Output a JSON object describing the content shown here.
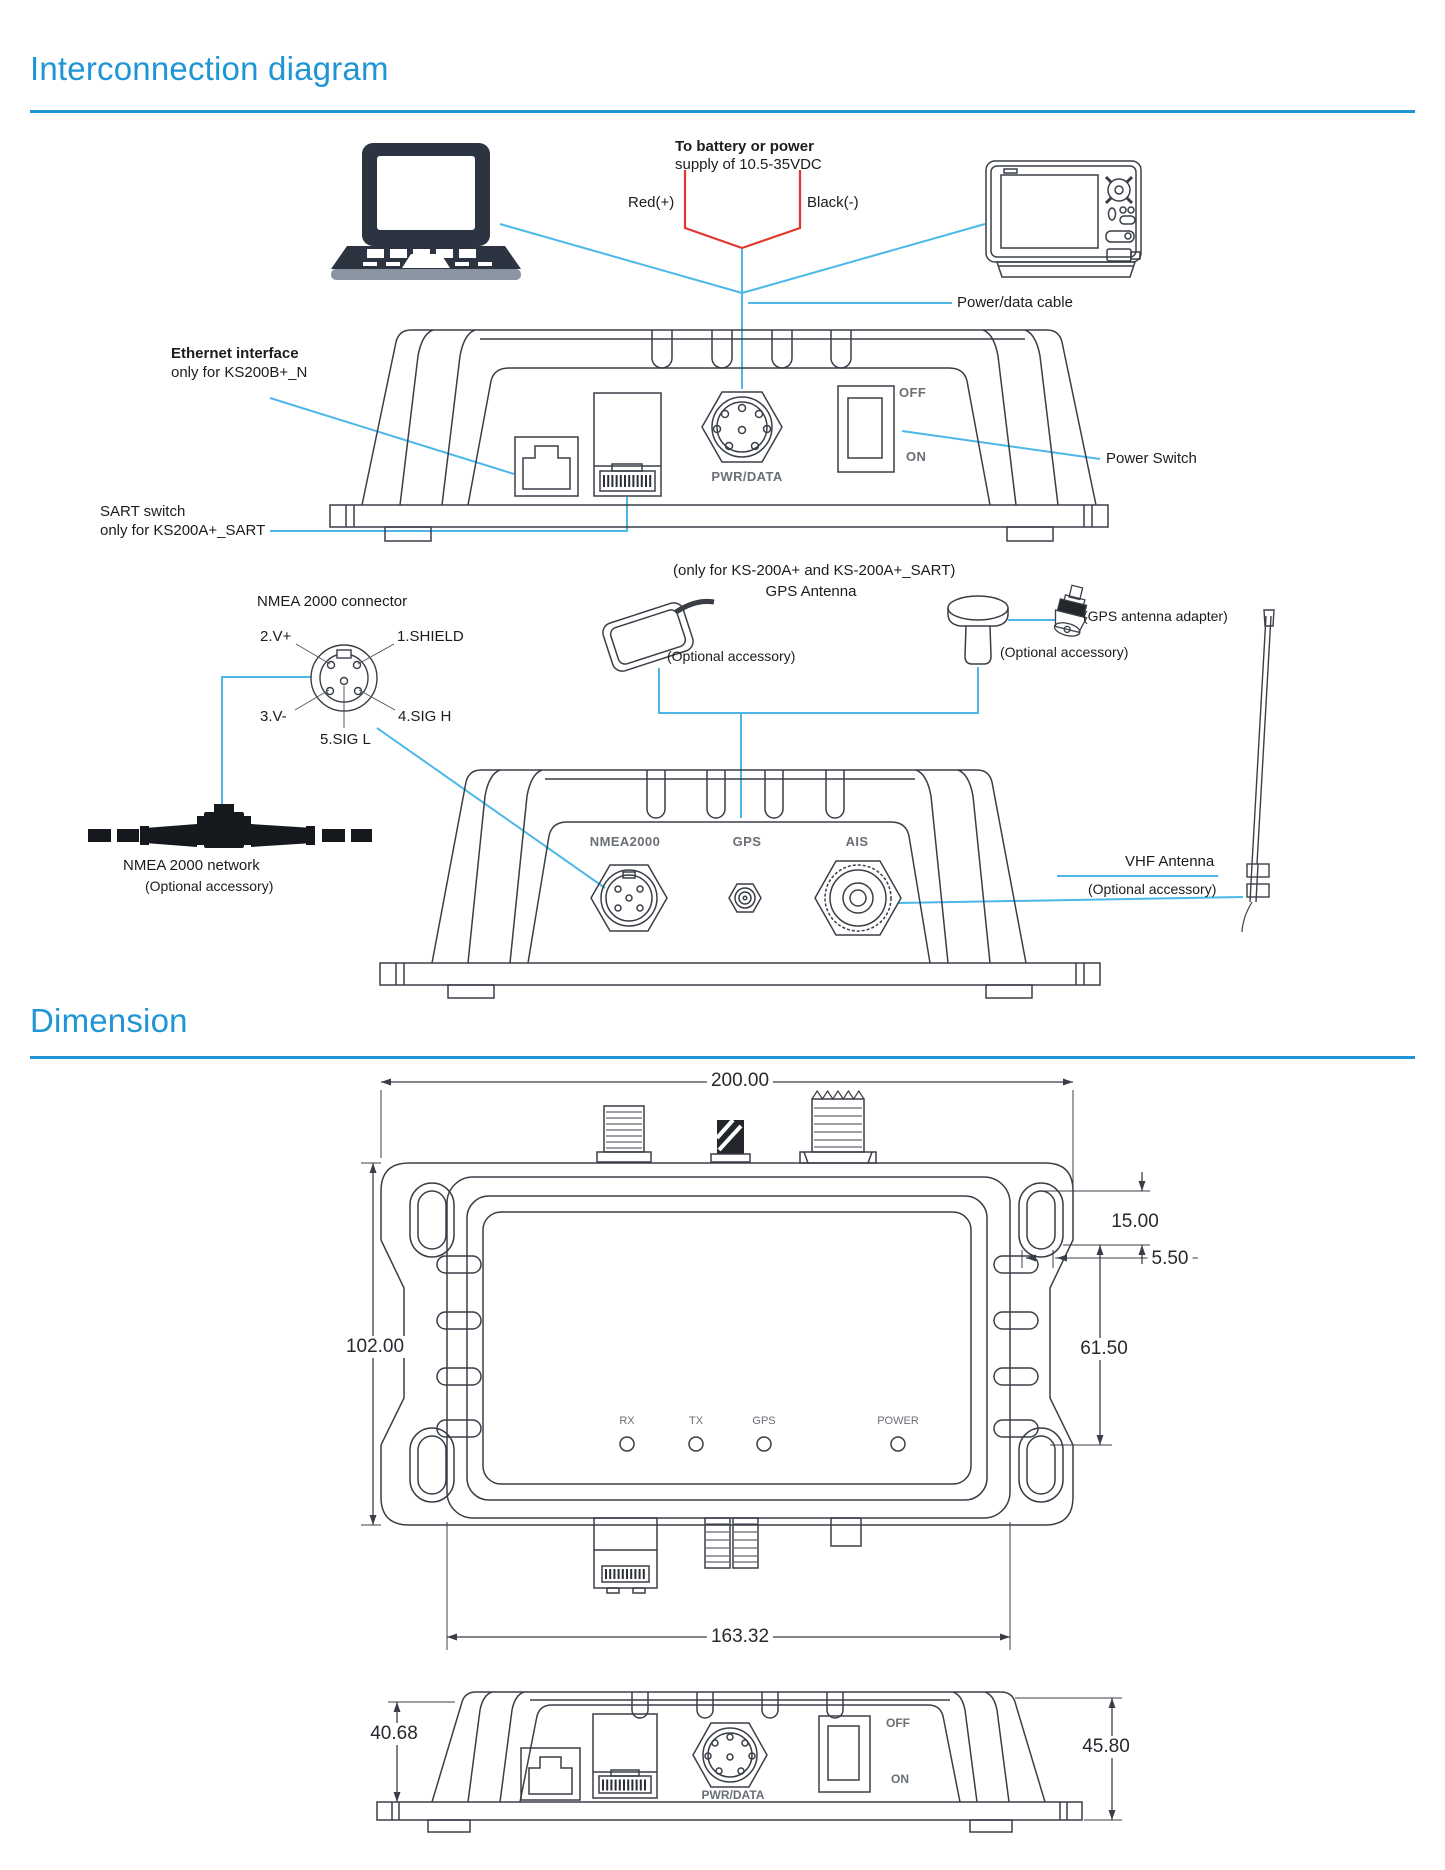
{
  "page": {
    "title1": "Interconnection diagram",
    "title2": "Dimension"
  },
  "colors": {
    "heading_blue": "#2095d5",
    "wire_blue": "#4cb8e8",
    "wire_red": "#e2382c",
    "ink": "#3a3f47"
  },
  "interconnection": {
    "battery": {
      "line1": "To battery or power",
      "line2": "supply of 10.5-35VDC",
      "red": "Red(+)",
      "black": "Black(-)"
    },
    "power_data_cable": "Power/data cable",
    "ethernet": {
      "line1": "Ethernet interface",
      "line2": "only for KS200B+_N"
    },
    "sart": {
      "line1": "SART switch",
      "line2": "only for KS200A+_SART"
    },
    "power_switch": "Power Switch",
    "rear_panel": {
      "off": "OFF",
      "on": "ON",
      "pwr_data": "PWR/DATA"
    },
    "nmea_pinout": {
      "title": "NMEA 2000 connector",
      "pin1": "1.SHIELD",
      "pin2": "2.V+",
      "pin3": "3.V-",
      "pin4": "4.SIG H",
      "pin5": "5.SIG L"
    },
    "gps": {
      "only_for": "(only for KS-200A+ and KS-200A+_SART)",
      "title": "GPS Antenna",
      "patch_optional": "(Optional accessory)",
      "mushroom_optional": "(Optional accessory)",
      "adapter": "(GPS antenna adapter)"
    },
    "front_panel": {
      "nmea2000": "NMEA2000",
      "gps": "GPS",
      "ais": "AIS"
    },
    "nmea_network": {
      "title": "NMEA 2000 network",
      "optional": "(Optional accessory)"
    },
    "vhf": {
      "title": "VHF Antenna",
      "optional": "(Optional accessory)"
    }
  },
  "dimension": {
    "top_width": "200.00",
    "slot_height": "15.00",
    "slot_offset": "5.50",
    "body_height": "102.00",
    "slot_span": "61.50",
    "bottom_width": "163.32",
    "rear_left": "40.68",
    "rear_right": "45.80",
    "leds": [
      "RX",
      "TX",
      "GPS",
      "POWER"
    ],
    "rear_panel": {
      "off": "OFF",
      "on": "ON",
      "pwr_data": "PWR/DATA"
    }
  }
}
